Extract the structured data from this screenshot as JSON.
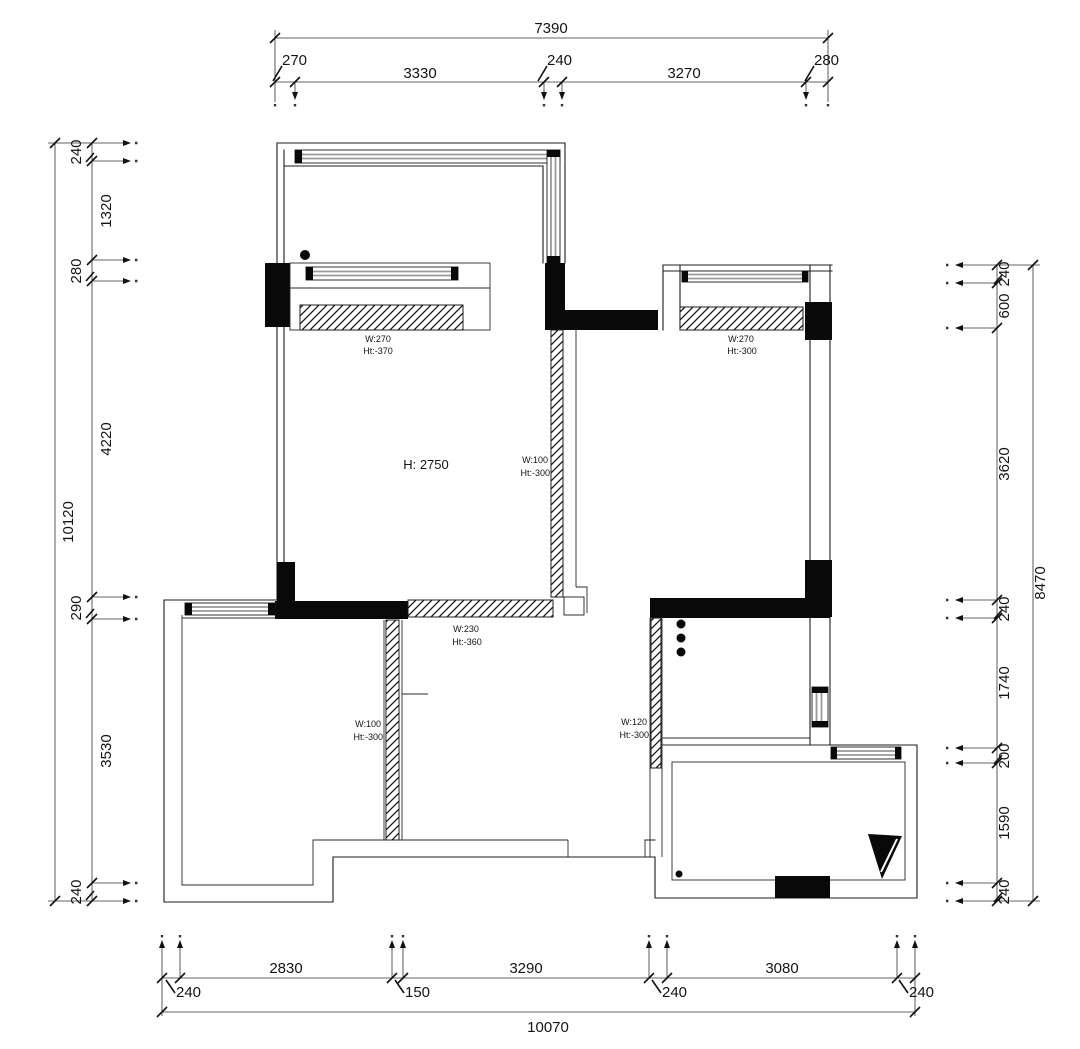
{
  "title": "apartment-floor-plan",
  "colors": {
    "line": "#1c1c1c",
    "window_glass": "#9a9a9a",
    "solid_wall": "#090909",
    "background": "#ffffff"
  },
  "dims": {
    "top": {
      "total": "7390",
      "seg": [
        "270",
        "3330",
        "240",
        "3270",
        "280"
      ]
    },
    "bottom": {
      "total": "10070",
      "seg": [
        "240",
        "2830",
        "150",
        "3290",
        "240",
        "3080",
        "240"
      ]
    },
    "left": {
      "total": "10120",
      "seg": [
        "240",
        "1320",
        "280",
        "4220",
        "290",
        "3530",
        "240"
      ]
    },
    "right": {
      "total": "8470",
      "seg": [
        "240",
        "600",
        "3620",
        "240",
        "1740",
        "200",
        "1590",
        "240"
      ]
    }
  },
  "labels": {
    "room_height": "H: 2750",
    "balcony_sill": {
      "w": "W:270",
      "h": "Ht:-370"
    },
    "bedroom_sill": {
      "w": "W:270",
      "h": "Ht:-300"
    },
    "mid_wall": {
      "w": "W:100",
      "h": "Ht:-300"
    },
    "south_wall": {
      "w": "W:230",
      "h": "Ht:-360"
    },
    "bedroom2_wall": {
      "w": "W:100",
      "h": "Ht:-300"
    },
    "kitchen_wall": {
      "w": "W:120",
      "h": "Ht:-300"
    }
  }
}
